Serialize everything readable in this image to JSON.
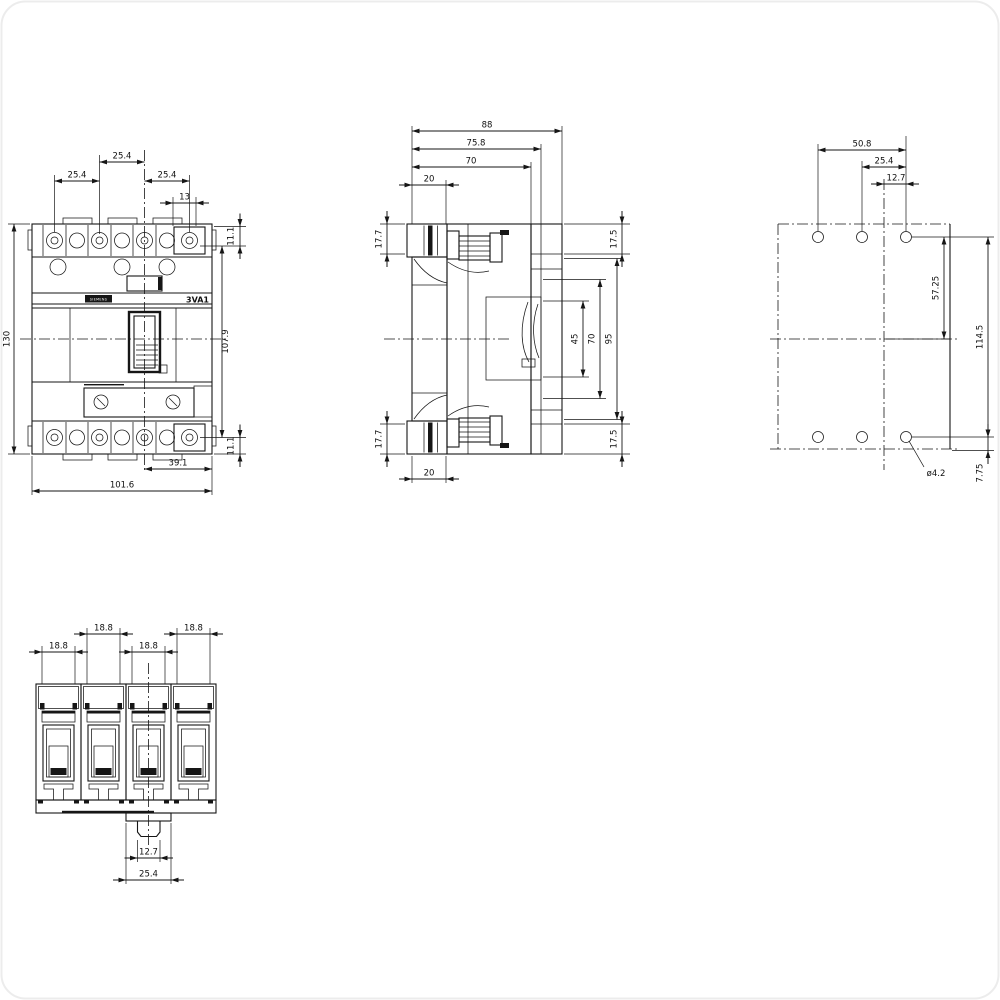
{
  "drawing": {
    "product": "3VA1",
    "brand": "SIEMENS"
  },
  "views": {
    "front": {
      "dims": {
        "pole_pitch_mid": "25.4",
        "pole_pitch_left": "25.4",
        "pole_pitch_right": "25.4",
        "terminal_width": "13",
        "screw_offset_top": "11.1",
        "overall_height": "130",
        "screw_span": "107.9",
        "screw_offset_bottom": "11.1",
        "center_to_edge": "39.1",
        "overall_width": "101.6"
      }
    },
    "side": {
      "dims": {
        "depth_overall": "88",
        "depth_rear_step": "75.8",
        "depth_body": "70",
        "front_step_top": "20",
        "terminal_top_left": "17.7",
        "terminal_top_right": "17.5",
        "cavity_span_45": "45",
        "cavity_span_70": "70",
        "rear_span_95": "95",
        "terminal_bottom_left": "17.7",
        "terminal_bottom_right": "17.5",
        "front_step_bottom": "20"
      }
    },
    "rear": {
      "dims": {
        "hole_span_outer": "50.8",
        "hole_span_mid": "25.4",
        "hole_to_centerline": "12.7",
        "hole_to_mid_height": "57.25",
        "hole_span_vertical": "114.5",
        "hole_to_bottom_edge": "7.75",
        "hole_diameter": "ø4.2"
      }
    },
    "bottom": {
      "dims": {
        "pole1_terminal_width": "18.8",
        "pole2_terminal_width": "18.8",
        "pole3_terminal_width": "18.8",
        "pole4_terminal_width": "18.8",
        "clip_inner_width": "12.7",
        "clip_outer_width": "25.4"
      }
    }
  }
}
